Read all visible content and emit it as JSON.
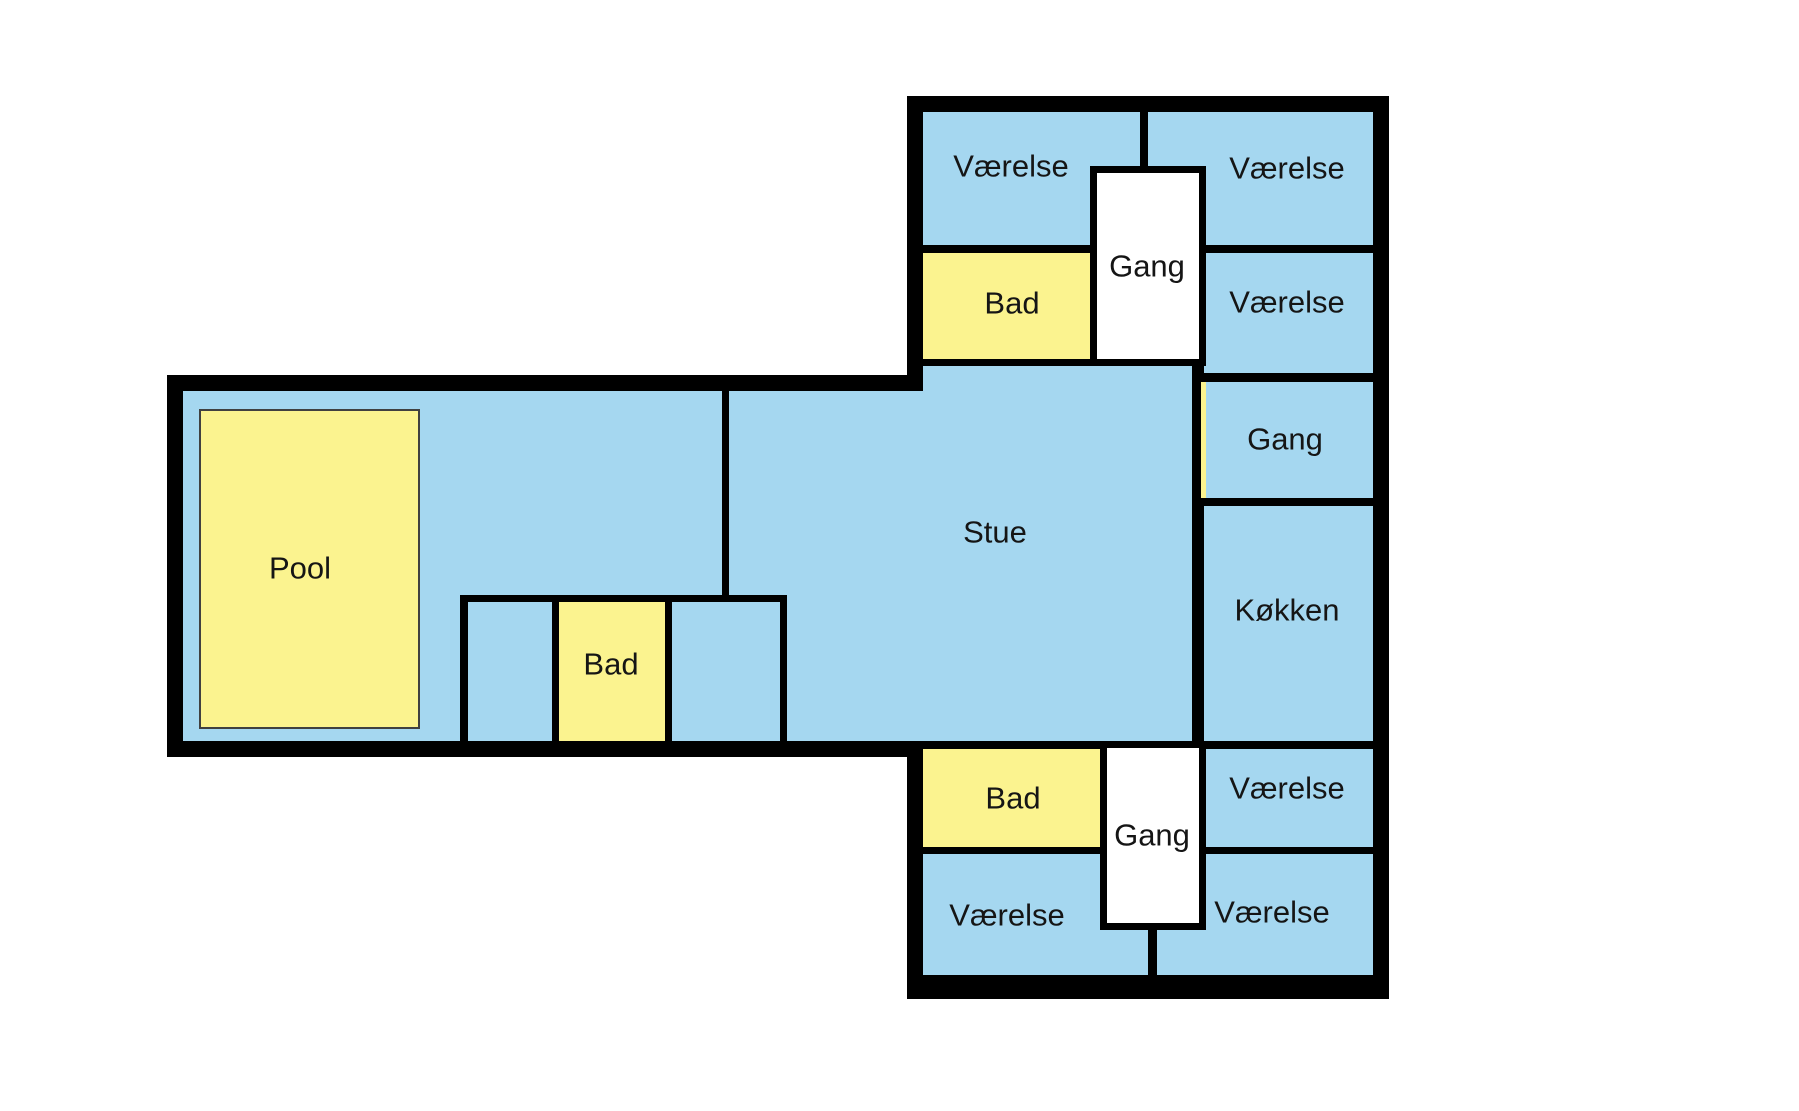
{
  "canvas": {
    "width": 1799,
    "height": 1111
  },
  "floorplan": {
    "background": "#ffffff",
    "colors": {
      "wall": "#000000",
      "room": "#a5d7f0",
      "wet": "#fbf38f",
      "hall": "#ffffff",
      "pool_fill": "#fbf38f",
      "pool_border": "#404040",
      "label": "#151515"
    },
    "label_style": {
      "font_size": 31
    },
    "shapes": [
      {
        "name": "wing-north-south-outer-wall",
        "x": 907,
        "y": 96,
        "w": 482,
        "h": 903,
        "fill": "wall"
      },
      {
        "name": "wing-west-outer-wall",
        "x": 167,
        "y": 375,
        "w": 756,
        "h": 382,
        "fill": "wall"
      },
      {
        "name": "wing-north-south-floor",
        "x": 923,
        "y": 112,
        "w": 450,
        "h": 863,
        "fill": "room"
      },
      {
        "name": "wing-west-floor",
        "x": 183,
        "y": 391,
        "w": 740,
        "h": 350,
        "fill": "room"
      },
      {
        "name": "wall-top-row-south",
        "x": 923,
        "y": 245,
        "w": 450,
        "h": 8,
        "fill": "wall"
      },
      {
        "name": "wall-top-vaerelse-divider",
        "x": 1140,
        "y": 112,
        "w": 8,
        "h": 60,
        "fill": "wall"
      },
      {
        "name": "wall-bad-top-south",
        "x": 923,
        "y": 359,
        "w": 169,
        "h": 7,
        "fill": "wall"
      },
      {
        "name": "wall-stue-east",
        "x": 1192,
        "y": 359,
        "w": 12,
        "h": 390,
        "fill": "wall"
      },
      {
        "name": "wall-gang-east-north",
        "x": 1204,
        "y": 373,
        "w": 169,
        "h": 9,
        "fill": "wall"
      },
      {
        "name": "wall-gang-east-south",
        "x": 1204,
        "y": 498,
        "w": 169,
        "h": 8,
        "fill": "wall"
      },
      {
        "name": "wall-koekken-south",
        "x": 1204,
        "y": 741,
        "w": 169,
        "h": 8,
        "fill": "wall"
      },
      {
        "name": "wall-vaerelse-east-south",
        "x": 1204,
        "y": 847,
        "w": 169,
        "h": 7,
        "fill": "wall"
      },
      {
        "name": "wall-stue-south",
        "x": 923,
        "y": 741,
        "w": 177,
        "h": 8,
        "fill": "wall"
      },
      {
        "name": "wall-bad-bottom-south",
        "x": 923,
        "y": 847,
        "w": 177,
        "h": 7,
        "fill": "wall"
      },
      {
        "name": "wall-bottom-vaerelse-divider",
        "x": 1148,
        "y": 923,
        "w": 9,
        "h": 52,
        "fill": "wall"
      },
      {
        "name": "wall-westwing-vertical",
        "x": 722,
        "y": 391,
        "w": 7,
        "h": 211,
        "fill": "wall"
      },
      {
        "name": "wall-cluster-north",
        "x": 460,
        "y": 595,
        "w": 327,
        "h": 7,
        "fill": "wall"
      },
      {
        "name": "wall-cluster-west",
        "x": 460,
        "y": 595,
        "w": 8,
        "h": 146,
        "fill": "wall"
      },
      {
        "name": "wall-cluster-mid-west",
        "x": 552,
        "y": 602,
        "w": 7,
        "h": 139,
        "fill": "wall"
      },
      {
        "name": "wall-cluster-mid-east",
        "x": 665,
        "y": 602,
        "w": 7,
        "h": 139,
        "fill": "wall"
      },
      {
        "name": "wall-cluster-east",
        "x": 780,
        "y": 595,
        "w": 7,
        "h": 146,
        "fill": "wall"
      },
      {
        "name": "room-bad-top",
        "x": 923,
        "y": 253,
        "w": 169,
        "h": 106,
        "fill": "wet"
      },
      {
        "name": "room-bad-bottom",
        "x": 923,
        "y": 749,
        "w": 177,
        "h": 98,
        "fill": "wet"
      },
      {
        "name": "room-bad-west",
        "x": 559,
        "y": 602,
        "w": 106,
        "h": 139,
        "fill": "wet"
      },
      {
        "name": "sliver-gang-east-edge",
        "x": 1201,
        "y": 382,
        "w": 5,
        "h": 116,
        "fill": "wet"
      },
      {
        "name": "gangbox-top-frame",
        "x": 1090,
        "y": 166,
        "w": 116,
        "h": 200,
        "fill": "wall"
      },
      {
        "name": "gangbox-top-floor",
        "x": 1097,
        "y": 173,
        "w": 102,
        "h": 186,
        "fill": "hall"
      },
      {
        "name": "gangbox-bottom-frame",
        "x": 1100,
        "y": 741,
        "w": 106,
        "h": 189,
        "fill": "wall"
      },
      {
        "name": "gangbox-bottom-floor",
        "x": 1107,
        "y": 748,
        "w": 92,
        "h": 175,
        "fill": "hall"
      },
      {
        "name": "pool-area",
        "x": 200,
        "y": 410,
        "w": 219,
        "h": 318,
        "fill": "pool_fill",
        "stroke": "pool_border",
        "stroke_width": 2
      }
    ],
    "labels": [
      {
        "name": "label-vaerelse-top-west",
        "text": "Værelse",
        "x": 1011,
        "y": 166
      },
      {
        "name": "label-vaerelse-top-east",
        "text": "Værelse",
        "x": 1287,
        "y": 168
      },
      {
        "name": "label-bad-top",
        "text": "Bad",
        "x": 1012,
        "y": 303
      },
      {
        "name": "label-gang-top",
        "text": "Gang",
        "x": 1147,
        "y": 266
      },
      {
        "name": "label-vaerelse-east-second",
        "text": "Værelse",
        "x": 1287,
        "y": 302
      },
      {
        "name": "label-gang-east",
        "text": "Gang",
        "x": 1285,
        "y": 439
      },
      {
        "name": "label-koekken",
        "text": "Køkken",
        "x": 1287,
        "y": 610
      },
      {
        "name": "label-stue",
        "text": "Stue",
        "x": 995,
        "y": 532
      },
      {
        "name": "label-pool",
        "text": "Pool",
        "x": 300,
        "y": 568
      },
      {
        "name": "label-bad-west",
        "text": "Bad",
        "x": 611,
        "y": 664
      },
      {
        "name": "label-bad-bottom",
        "text": "Bad",
        "x": 1013,
        "y": 798
      },
      {
        "name": "label-gang-bottom",
        "text": "Gang",
        "x": 1152,
        "y": 835
      },
      {
        "name": "label-vaerelse-east-mid",
        "text": "Værelse",
        "x": 1287,
        "y": 788
      },
      {
        "name": "label-vaerelse-bottom-west",
        "text": "Værelse",
        "x": 1007,
        "y": 915
      },
      {
        "name": "label-vaerelse-bottom-east",
        "text": "Værelse",
        "x": 1272,
        "y": 912
      }
    ]
  }
}
